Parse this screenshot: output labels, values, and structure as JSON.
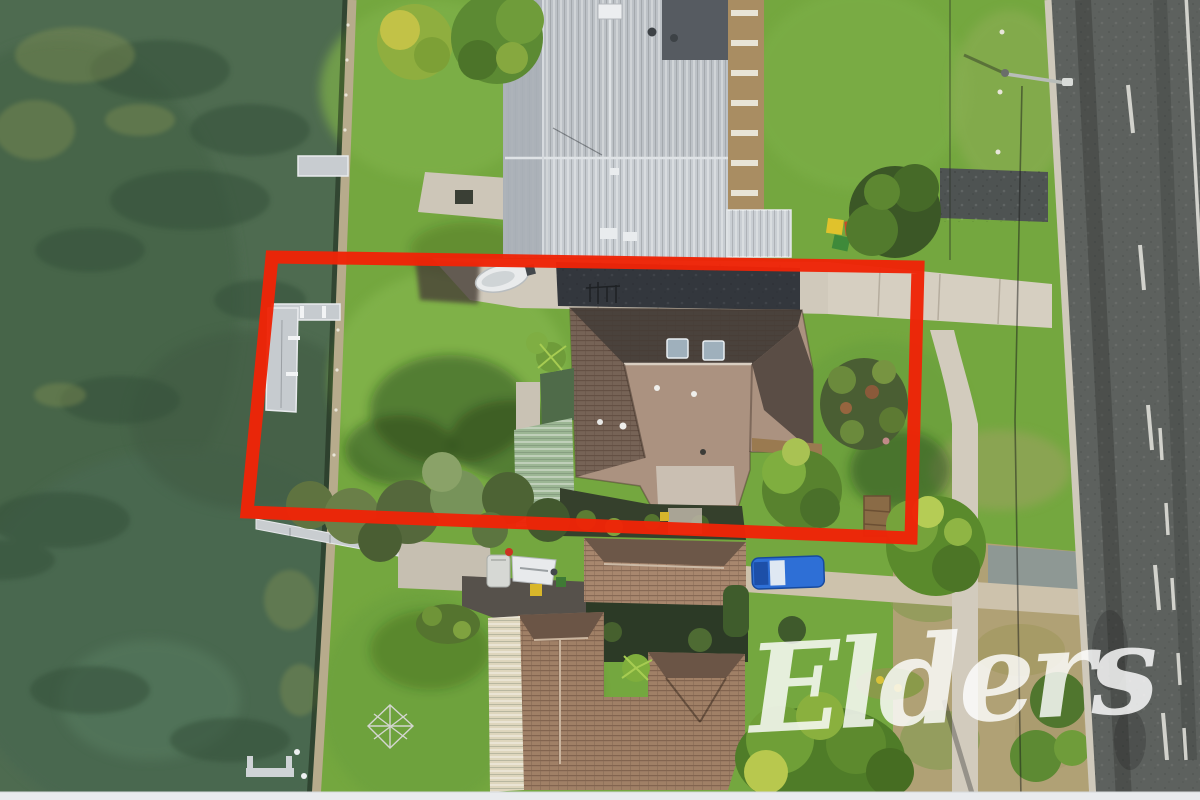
{
  "meta": {
    "alt": "Aerial drone photograph of a waterfront residential property outlined in red, with a lake and jetties on the left, neighbouring houses, and a road on the right"
  },
  "watermark": {
    "text": "Elders",
    "color": "#ffffff"
  },
  "boundary": {
    "color": "#ee2407"
  }
}
